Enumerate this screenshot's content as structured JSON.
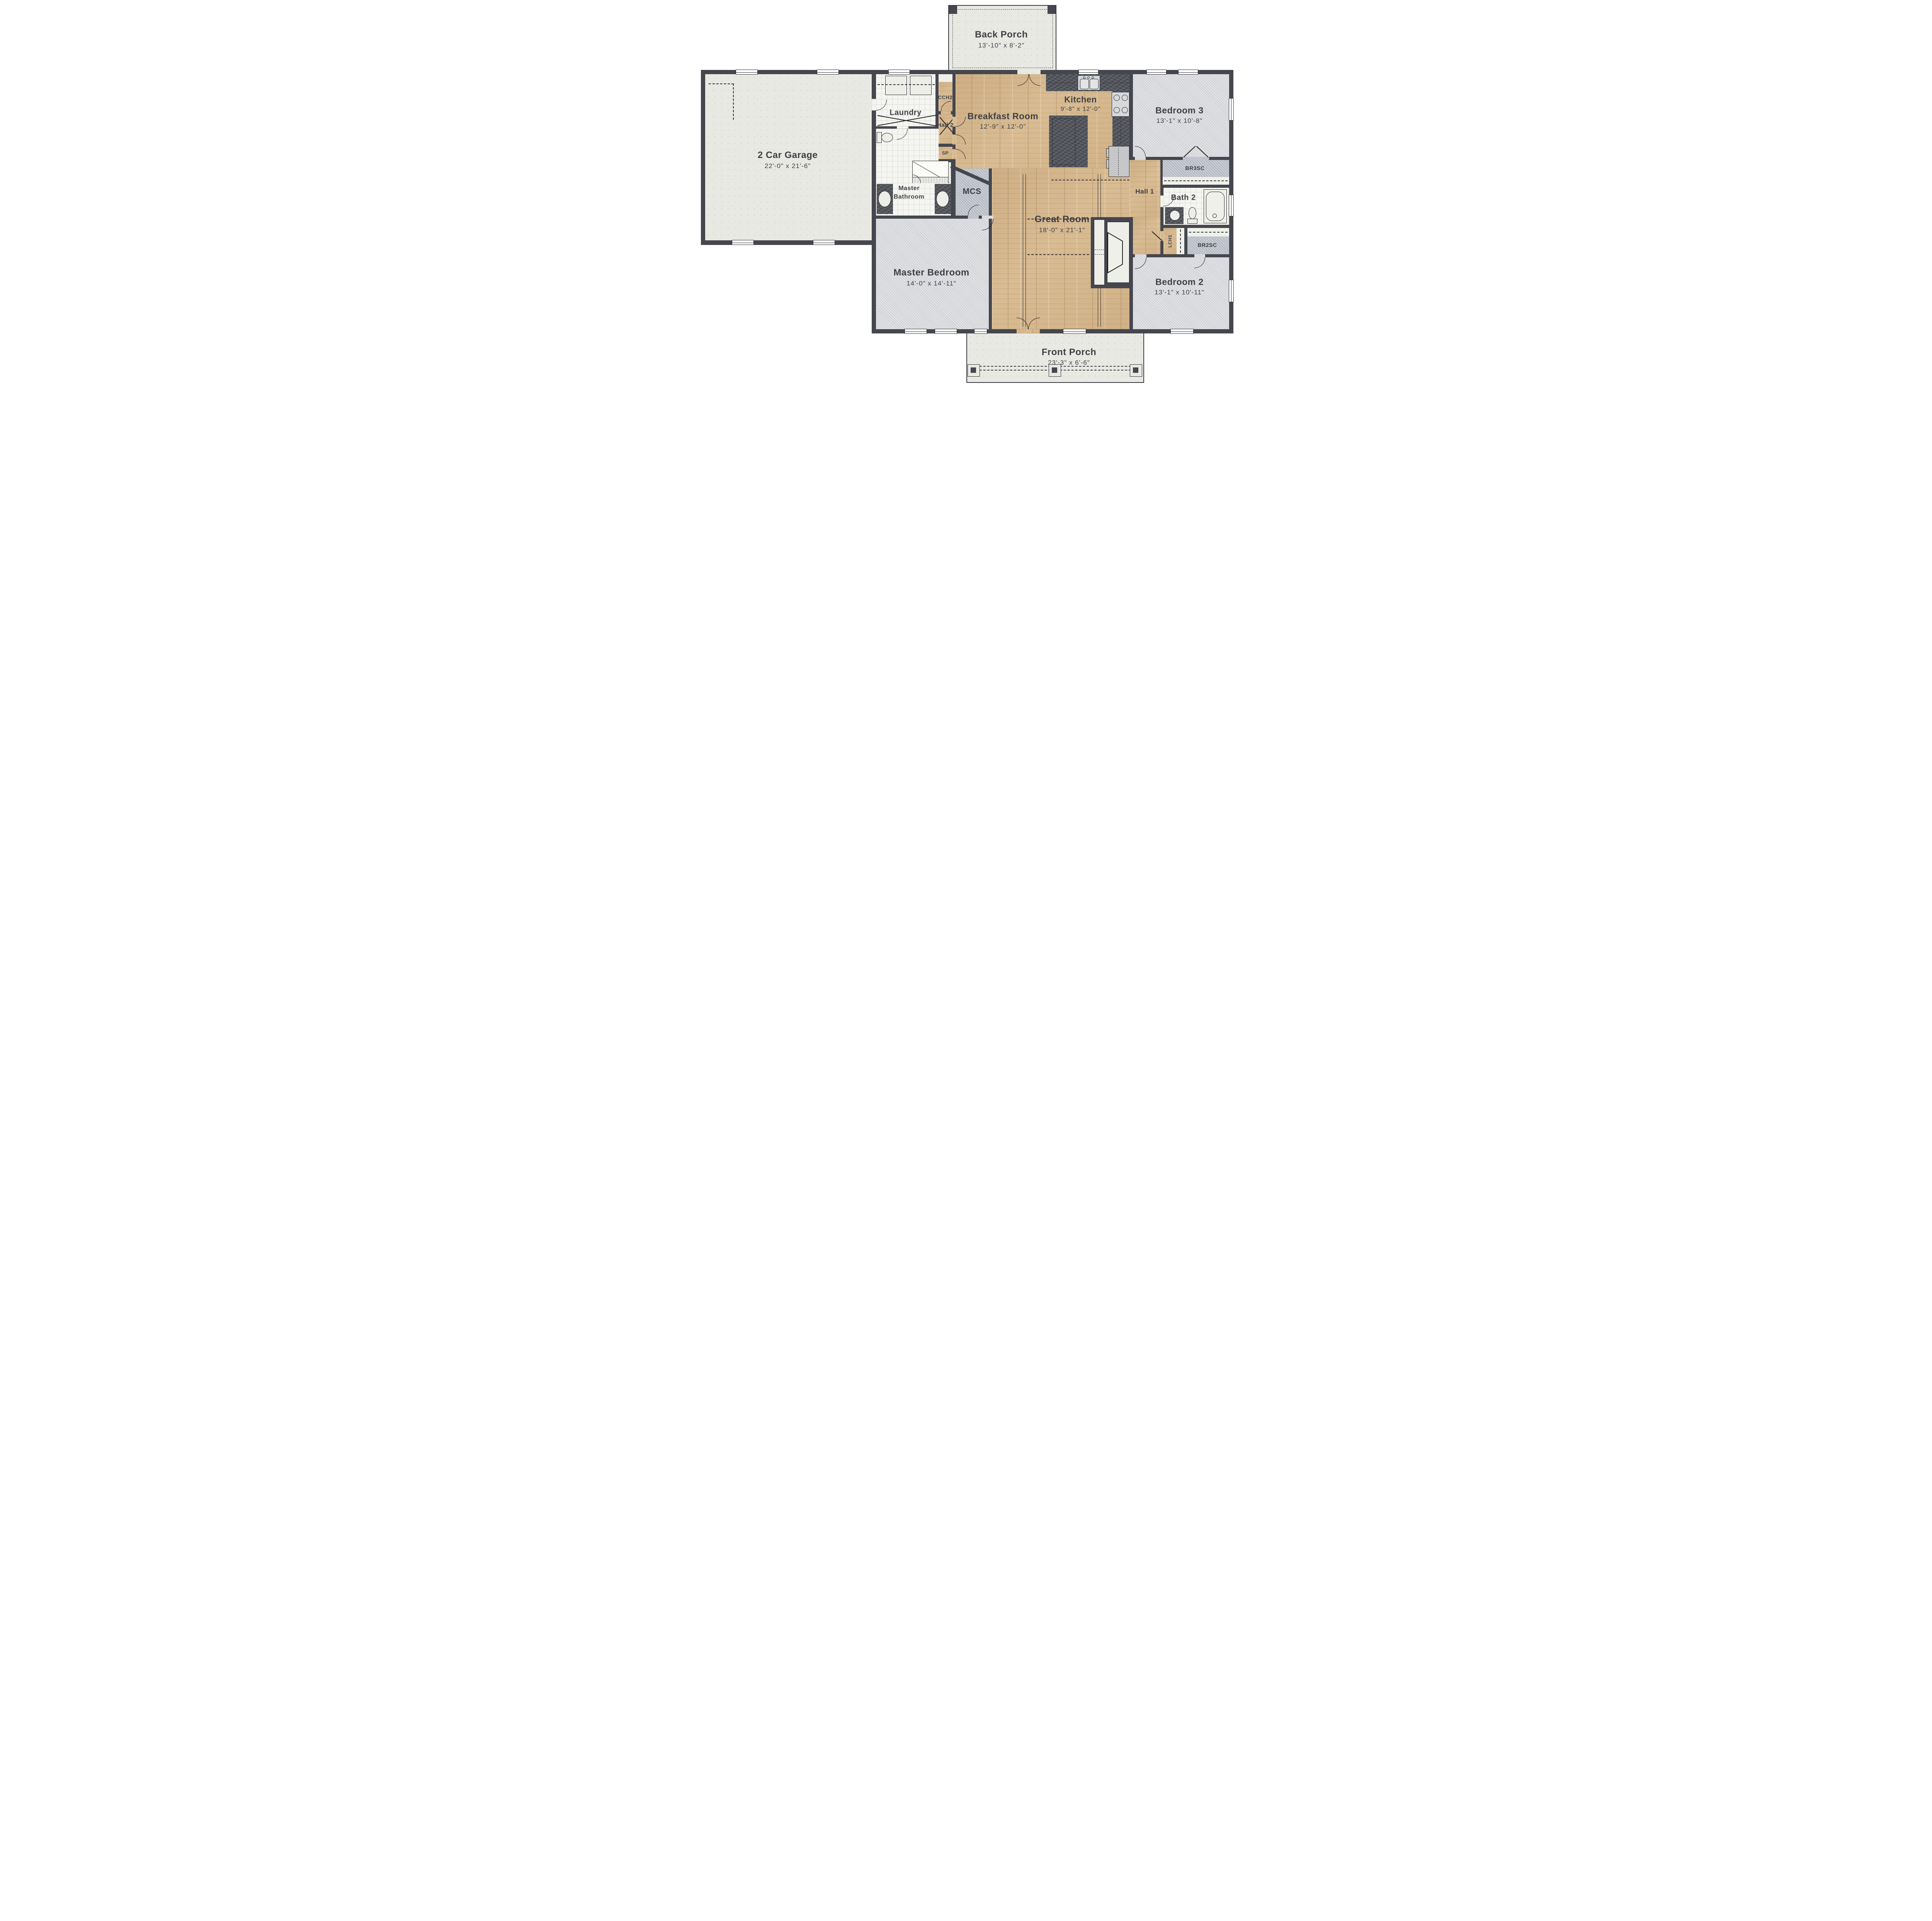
{
  "rooms": {
    "back_porch": {
      "name": "Back Porch",
      "dims": "13'-10\" x 8'-2\""
    },
    "garage": {
      "name": "2 Car Garage",
      "dims": "22'-0\" x 21'-6\""
    },
    "laundry": {
      "name": "Laundry"
    },
    "cch2": {
      "name": "CCH2"
    },
    "hall2": {
      "name": "Hall 2"
    },
    "sp": {
      "name": "SP"
    },
    "breakfast": {
      "name": "Breakfast Room",
      "dims": "12'-9\" x 12'-0\""
    },
    "kitchen": {
      "name": "Kitchen",
      "dims": "9'-8\" x 12'-0\""
    },
    "bedroom3": {
      "name": "Bedroom 3",
      "dims": "13'-1\" x 10'-8\""
    },
    "br3sc": {
      "name": "BR3SC"
    },
    "master_bathroom": {
      "name_line1": "Master",
      "name_line2": "Bathroom"
    },
    "mcs": {
      "name": "MCS"
    },
    "hall1": {
      "name": "Hall 1"
    },
    "bath2": {
      "name": "Bath 2"
    },
    "great_room": {
      "name": "Great Room",
      "dims": "18'-0\" x 21'-1\""
    },
    "lch1": {
      "name": "LCH1"
    },
    "br2sc": {
      "name": "BR2SC"
    },
    "master_bedroom": {
      "name": "Master Bedroom",
      "dims": "14'-0\" x 14'-11\""
    },
    "bedroom2": {
      "name": "Bedroom 2",
      "dims": "13'-1\" x 10'-11\""
    },
    "front_porch": {
      "name": "Front Porch",
      "dims": "23'-3\" x 6'-6\""
    }
  },
  "colors": {
    "wall": "#45464e",
    "wood": "#d9bc93",
    "carpet": "#d5d7da",
    "carpet2": "#b8bdc7",
    "tile": "#f5f5f2",
    "conc": "#e9e9e3",
    "granite": "#55575f",
    "fix": "#edeee8",
    "ink": "#3d4046"
  }
}
